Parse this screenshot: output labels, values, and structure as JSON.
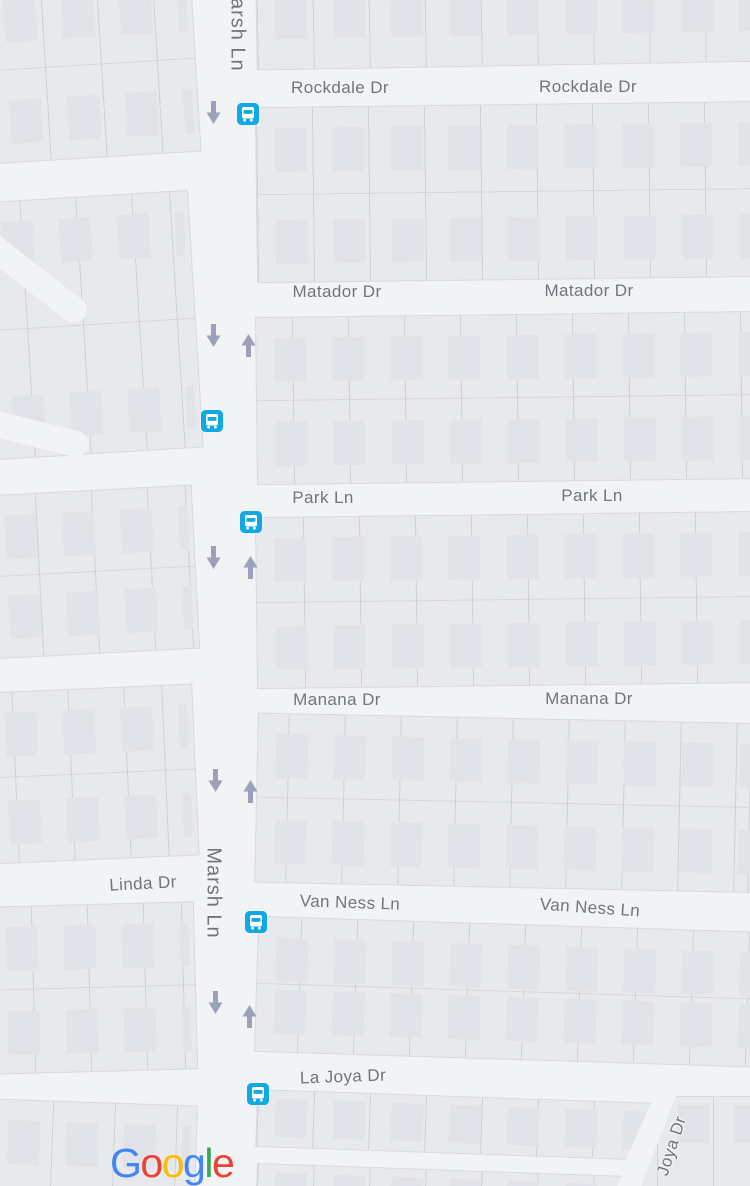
{
  "map": {
    "street_labels": [
      {
        "text": "Rockdale Dr"
      },
      {
        "text": "Rockdale Dr"
      },
      {
        "text": "Matador Dr"
      },
      {
        "text": "Matador Dr"
      },
      {
        "text": "Park Ln"
      },
      {
        "text": "Park Ln"
      },
      {
        "text": "Manana Dr"
      },
      {
        "text": "Manana Dr"
      },
      {
        "text": "Linda Dr"
      },
      {
        "text": "Marsh Ln"
      },
      {
        "text": "Marsh Ln"
      },
      {
        "text": "Van Ness Ln"
      },
      {
        "text": "Van Ness Ln"
      },
      {
        "text": "La Joya Dr"
      },
      {
        "text": "Joya Dr"
      }
    ],
    "transit_stop_count": 5,
    "one_way_arrows": {
      "down": 5,
      "up": 4
    },
    "colors": {
      "road": "#f2f3f5",
      "block": "#e8e9ed",
      "building": "#e1e3e8",
      "parcel_line": "#d9dbe0",
      "label_text": "#70747c",
      "arrow": "#9ba1b9",
      "transit_blue": "#10a9e3",
      "logo_blue": "#4285F4",
      "logo_red": "#EA4335",
      "logo_yellow": "#FBBC05",
      "logo_green": "#34A853"
    },
    "provider_logo": {
      "letters": [
        {
          "ch": "G",
          "color": "#4285F4"
        },
        {
          "ch": "o",
          "color": "#EA4335"
        },
        {
          "ch": "o",
          "color": "#FBBC05"
        },
        {
          "ch": "g",
          "color": "#4285F4"
        },
        {
          "ch": "l",
          "color": "#34A853"
        },
        {
          "ch": "e",
          "color": "#EA4335"
        }
      ]
    }
  }
}
